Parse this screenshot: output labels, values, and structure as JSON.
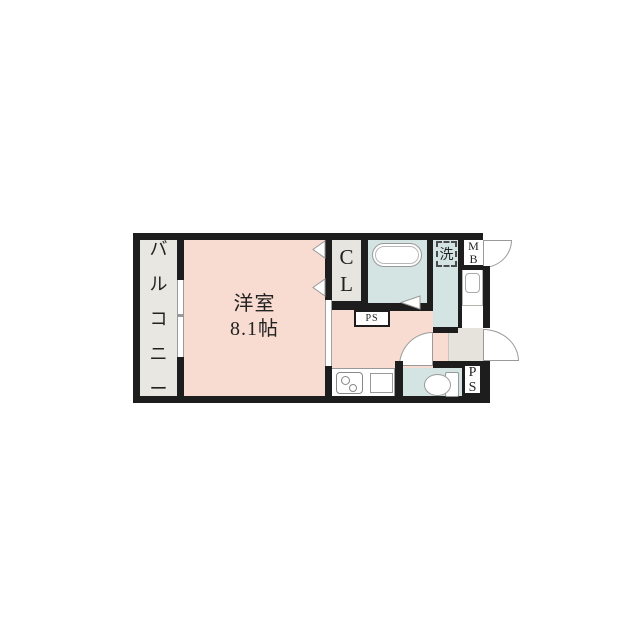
{
  "page": {
    "background": "#ffffff",
    "type": "apartment-floor-plan"
  },
  "colors": {
    "wall": "#1d1d1d",
    "room_pink": "#f8dcd1",
    "wet_area_blue": "#d4e4e3",
    "balcony_gray": "#e8e7e2",
    "closet_gray": "#e6e5e0",
    "entrance_gray": "#e6e3dd",
    "fixture_outline": "#999999",
    "label_text": "#222222"
  },
  "labels": {
    "balcony": {
      "text": "バルコニー",
      "chars": [
        "バ",
        "ル",
        "コ",
        "ニ",
        "ー"
      ]
    },
    "main_room": {
      "name": "洋室",
      "size": "8.1帖"
    },
    "closet": {
      "text": "CL",
      "chars": [
        "C",
        "L"
      ]
    },
    "laundry": {
      "text": "洗"
    },
    "meter_box": {
      "text": "MB",
      "chars": [
        "M",
        "B"
      ]
    },
    "pipe_space_upper": {
      "text": "PS"
    },
    "pipe_space_lower": {
      "text": "PS",
      "chars": [
        "P",
        "S"
      ]
    }
  }
}
